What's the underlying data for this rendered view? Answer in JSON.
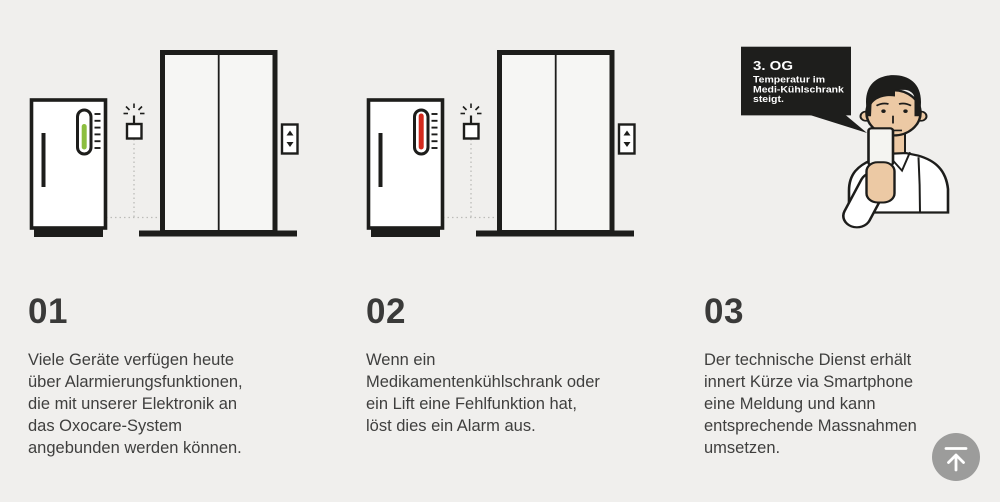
{
  "page": {
    "background": "#f0efed"
  },
  "colors": {
    "ink": "#1d1d1b",
    "text": "#3c3c3b",
    "thermometer_ok_green": "#8cbe3f",
    "thermometer_alarm_red": "#d3291d",
    "skin": "#ecc9a4",
    "door_fill": "#f6f6f4",
    "bubble_black": "#1e1e1c",
    "scroll_button_gray": "#9c9c9b",
    "dotted_line": "#bcbcb9",
    "icon_white": "#ffffff"
  },
  "steps": [
    {
      "number": "01",
      "text": "Viele Geräte verfügen heute\nüber Alarmierungsfunktionen,\ndie mit unserer Elektronik an\ndas Oxocare-System\nangebunden werden können."
    },
    {
      "number": "02",
      "text": "Wenn ein\nMedikamentenkühlschrank oder\nein Lift eine Fehlfunktion hat,\nlöst dies ein Alarm aus."
    },
    {
      "number": "03",
      "text": "Der technische Dienst erhält\ninnert Kürze via Smartphone\neine Meldung und kann\nentsprechende Massnahmen\numsetzen."
    }
  ],
  "speech_bubble": {
    "title": "3. OG",
    "lines": [
      "Temperatur im",
      "Medi-Kühlschrank",
      "steigt."
    ]
  },
  "icons": {
    "scroll_to_top": "arrow-up-to-line",
    "sensor": "wireless-sensor-burst",
    "elevator_call": "up-down-triangles",
    "thermometer": "capsule-thermometer"
  }
}
